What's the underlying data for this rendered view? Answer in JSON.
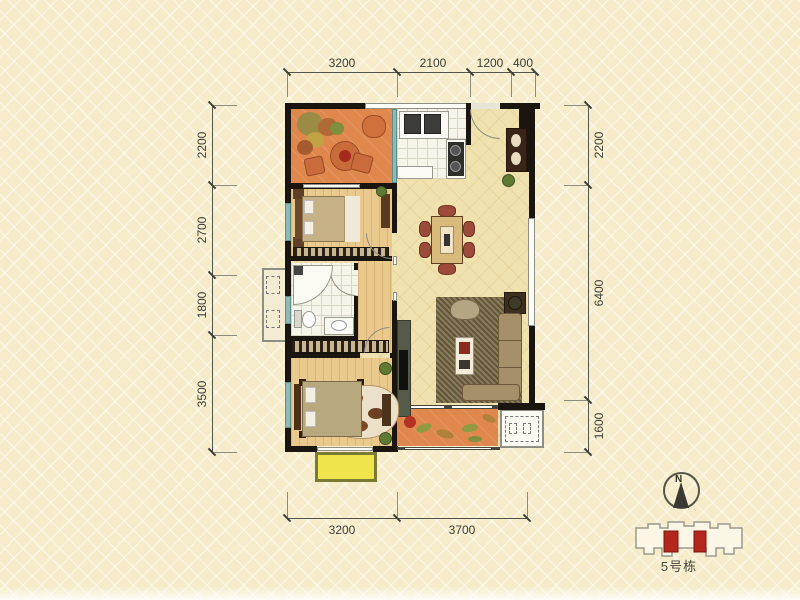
{
  "dimensions": {
    "top": [
      "3200",
      "2100",
      "1200",
      "400"
    ],
    "bottom": [
      "3200",
      "3700"
    ],
    "left": [
      "2200",
      "2700",
      "1800",
      "3500"
    ],
    "right": [
      "2200",
      "6400",
      "1600"
    ]
  },
  "compass": {
    "north_label": "N"
  },
  "site_plan": {
    "building_label": "5号栋"
  },
  "colors": {
    "background": "#f6ecca",
    "wall": "#1b1510",
    "balcony_floor": "#e0874d",
    "wood_floor": "#eac98c",
    "main_floor": "#f0e2ae",
    "kitchen_floor": "#f7f5ea",
    "teal_window": "#8fb9b5",
    "bay_window": "#efe44b",
    "unit_highlight": "#b3271d"
  }
}
